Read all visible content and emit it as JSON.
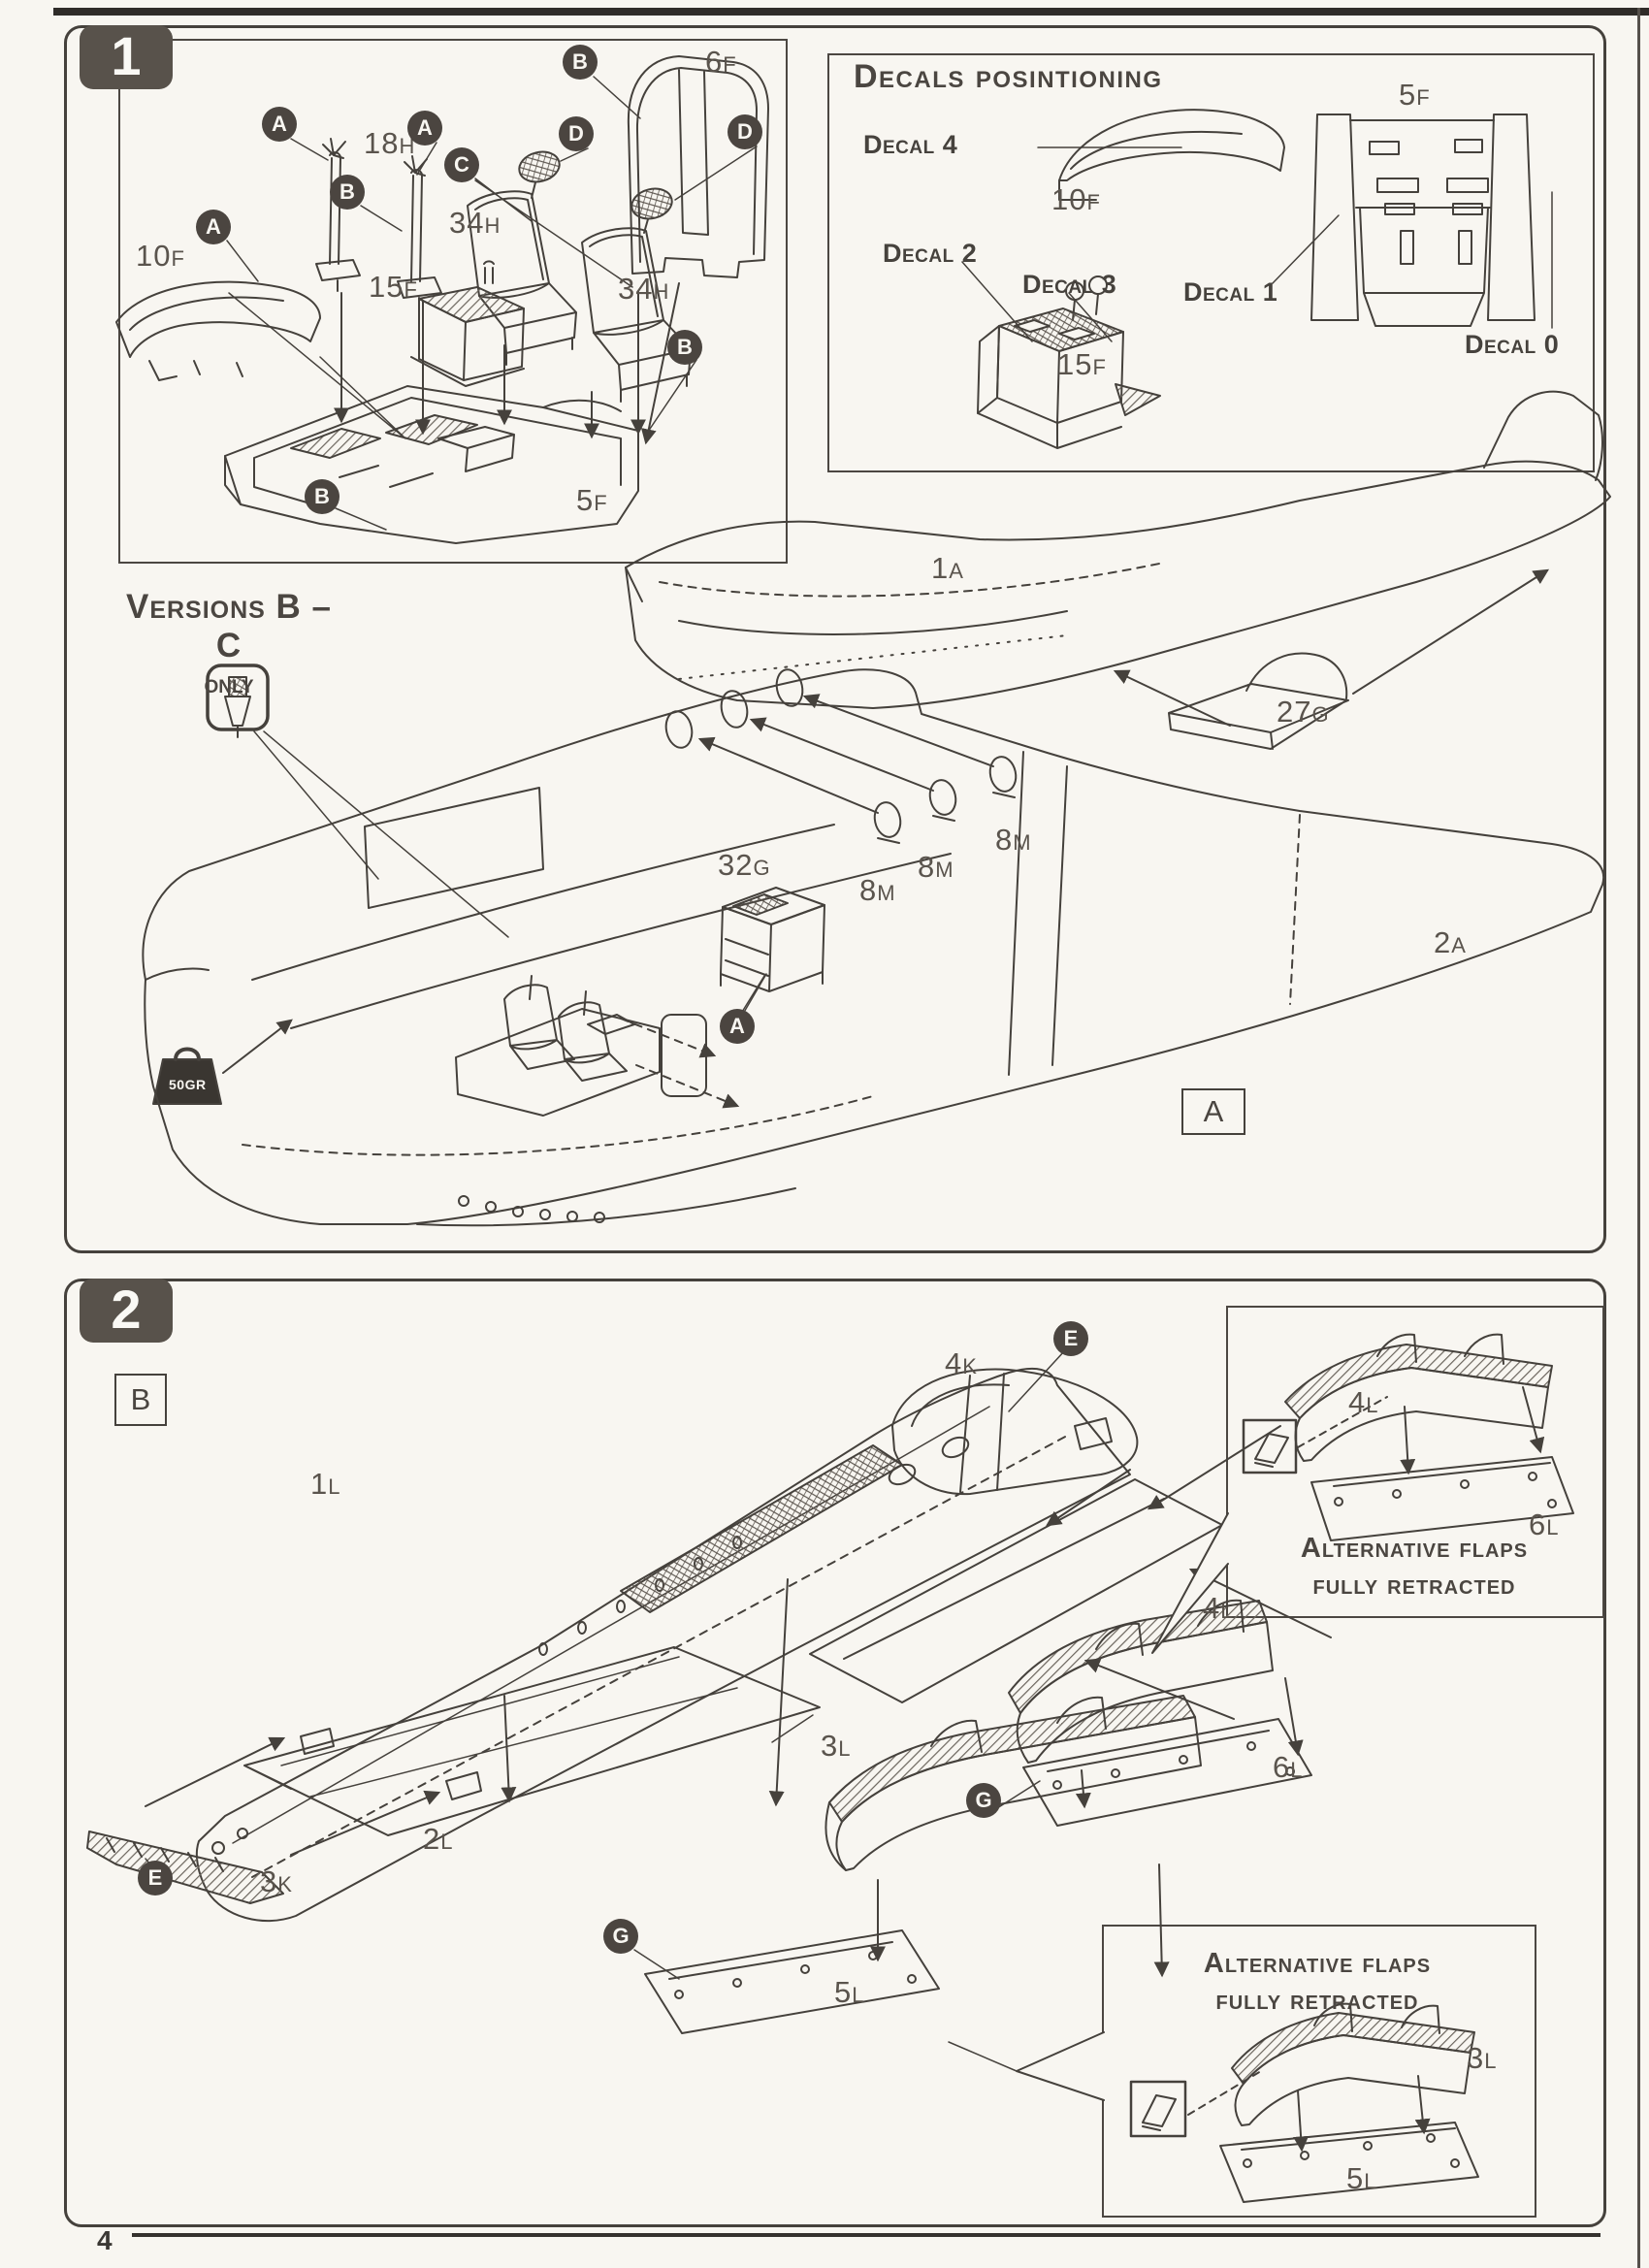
{
  "page": {
    "number": "4"
  },
  "step1": {
    "badge": "1",
    "inset": {
      "parts": {
        "p10F": {
          "n": "10",
          "s": "F"
        },
        "p18H": {
          "n": "18",
          "s": "H"
        },
        "p15F": {
          "n": "15",
          "s": "F"
        },
        "p34Ha": {
          "n": "34",
          "s": "H"
        },
        "p34Hb": {
          "n": "34",
          "s": "H"
        },
        "p6F": {
          "n": "6",
          "s": "F"
        },
        "p5F": {
          "n": "5",
          "s": "F"
        }
      },
      "callouts": {
        "a1": "A",
        "a2": "A",
        "a3": "A",
        "b1": "B",
        "b_top": "B",
        "b_left": "B",
        "b_right": "B",
        "c": "C",
        "d1": "D",
        "d2": "D"
      }
    },
    "decals": {
      "title": "Decals posintioning",
      "decal4": "Decal 4",
      "decal2": "Decal 2",
      "decal3": "Decal 3",
      "decal1": "Decal 1",
      "decal0": "Decal 0",
      "parts": {
        "p10F": {
          "n": "10",
          "s": "F"
        },
        "p15F": {
          "n": "15",
          "s": "F"
        },
        "p5F": {
          "n": "5",
          "s": "F"
        }
      }
    },
    "versions_note": {
      "line1": "Versions B – C",
      "line2": "only"
    },
    "weight_label": "50GR",
    "main": {
      "parts": {
        "p1A": {
          "n": "1",
          "s": "A"
        },
        "p2A": {
          "n": "2",
          "s": "A"
        },
        "p27G": {
          "n": "27",
          "s": "G"
        },
        "p32G": {
          "n": "32",
          "s": "G"
        },
        "p8Ma": {
          "n": "8",
          "s": "M"
        },
        "p8Mb": {
          "n": "8",
          "s": "M"
        },
        "p8Mc": {
          "n": "8",
          "s": "M"
        }
      },
      "callout_a": "A",
      "version_tag": "A"
    }
  },
  "step2": {
    "badge": "2",
    "version_tag": "B",
    "parts": {
      "p1L": {
        "n": "1",
        "s": "L"
      },
      "p2L": {
        "n": "2",
        "s": "L"
      },
      "p3K": {
        "n": "3",
        "s": "K"
      },
      "p3L": {
        "n": "3",
        "s": "L"
      },
      "p4K": {
        "n": "4",
        "s": "K"
      },
      "p4L": {
        "n": "4",
        "s": "L"
      },
      "p5L": {
        "n": "5",
        "s": "L"
      },
      "p6L": {
        "n": "6",
        "s": "L"
      }
    },
    "callouts": {
      "e1": "E",
      "e2": "E",
      "g1": "G",
      "g2": "G"
    },
    "alt_top": {
      "title1": "Alternative flaps",
      "title2": "fully retracted",
      "p4L": {
        "n": "4",
        "s": "L"
      },
      "p6L": {
        "n": "6",
        "s": "L"
      }
    },
    "alt_bottom": {
      "title1": "Alternative flaps",
      "title2": "fully retracted",
      "p3L": {
        "n": "3",
        "s": "L"
      },
      "p5L": {
        "n": "5",
        "s": "L"
      }
    }
  }
}
